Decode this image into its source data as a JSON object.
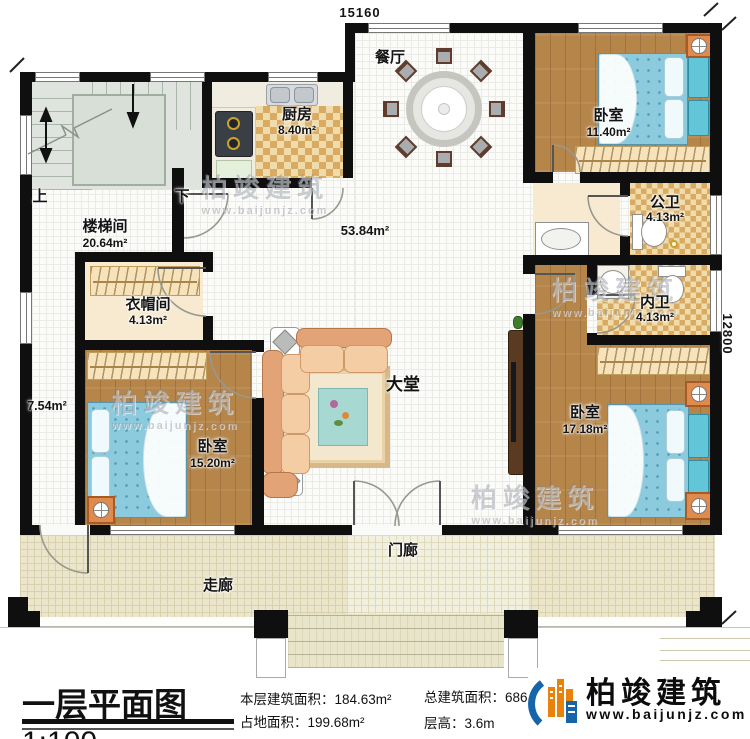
{
  "dimensions": {
    "top_width": "15160",
    "right_height": "12800"
  },
  "rooms": {
    "stairwell": {
      "name": "楼梯间",
      "area": "20.64m²",
      "up": "上",
      "down": "下"
    },
    "kitchen": {
      "name": "厨房",
      "area": "8.40m²"
    },
    "dining": {
      "name": "餐厅"
    },
    "open_area": {
      "area": "53.84m²"
    },
    "hall": {
      "name": "大堂"
    },
    "cloakroom": {
      "name": "衣帽间",
      "area": "4.13m²"
    },
    "hallway": {
      "area": "7.54m²"
    },
    "bedroom1": {
      "name": "卧室",
      "area": "15.20m²"
    },
    "bedroom2": {
      "name": "卧室",
      "area": "11.40m²"
    },
    "bedroom3": {
      "name": "卧室",
      "area": "17.18m²"
    },
    "public_bath": {
      "name": "公卫",
      "area": "4.13m²"
    },
    "private_bath": {
      "name": "内卫",
      "area": "4.13m²"
    },
    "porch": {
      "name": "门廊"
    },
    "corridor": {
      "name": "走廊"
    }
  },
  "watermark": {
    "name": "柏竣建筑",
    "url": "www.baijunjz.com"
  },
  "title_block": {
    "title": "一层平面图",
    "scale": "1:100",
    "stats": [
      {
        "label": "本层建筑面积：",
        "value": "184.63m²"
      },
      {
        "label": "占地面积：",
        "value": "199.68m²"
      },
      {
        "label": "总建筑面积：",
        "value": "686.50m²"
      },
      {
        "label": "层高：",
        "value": "3.6m"
      }
    ]
  },
  "logo": {
    "name": "柏竣建筑",
    "url": "www.baijunjz.com"
  },
  "colors": {
    "wall": "#0f0f0f",
    "wood_floor": "#b5854a",
    "tile_accent": "#d9ab62",
    "bed": "#8ccadd",
    "veranda": "#eae5cb",
    "logo_blue": "#1565a8",
    "logo_orange": "#e8820c"
  }
}
